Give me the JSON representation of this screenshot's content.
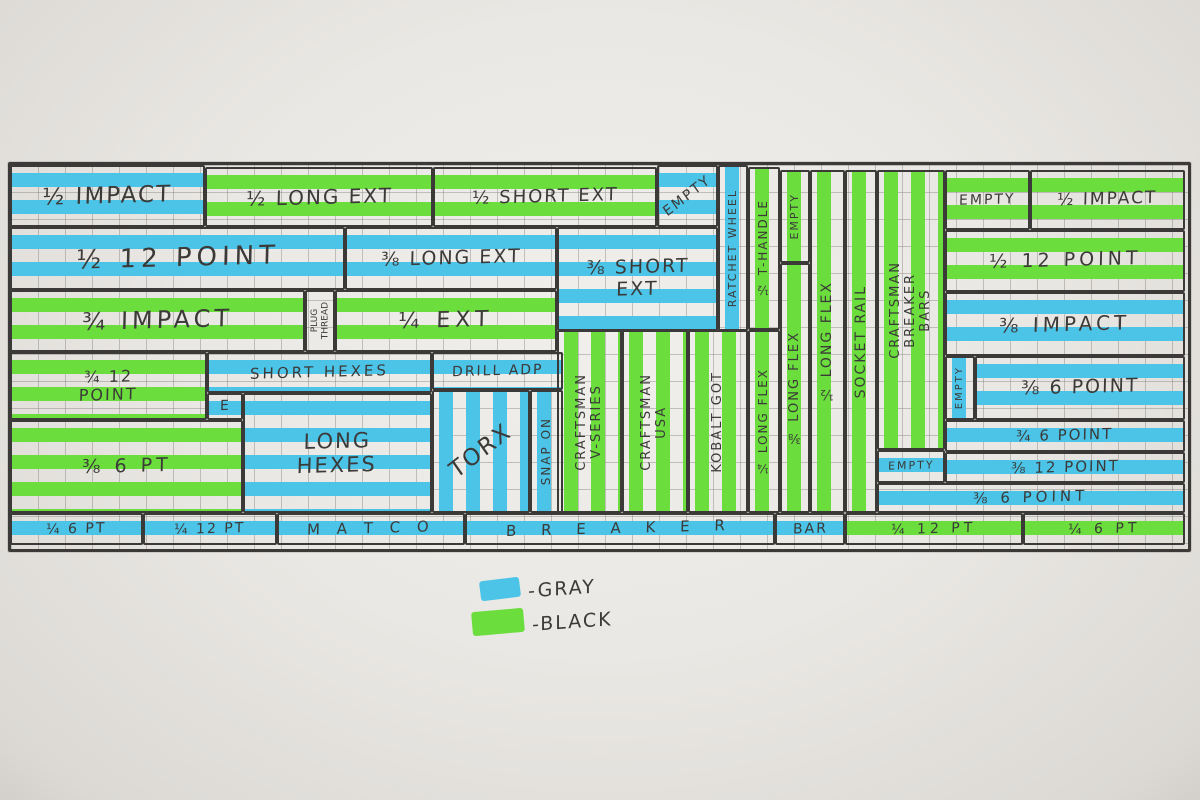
{
  "colors": {
    "blue": "#4cc4e8",
    "green": "#6bdd3d",
    "ink": "#3b3a38",
    "paper": "#eae8e4",
    "grid_line": "#696661"
  },
  "legend": {
    "items": [
      {
        "name": "gray",
        "label": "-GRAY",
        "color": "#4cc4e8"
      },
      {
        "name": "black",
        "label": "-BLACK",
        "color": "#6bdd3d"
      }
    ]
  },
  "cells": [
    {
      "name": "cell-half-impact-left",
      "label": "½ IMPACT",
      "marker": "blue",
      "stripes": "h",
      "orient": "h",
      "box": [
        10,
        165,
        195,
        62
      ],
      "fs": 23
    },
    {
      "name": "cell-half-long-ext",
      "label": "½ LONG EXT",
      "marker": "green",
      "stripes": "h",
      "orient": "h",
      "box": [
        205,
        167,
        228,
        60
      ],
      "fs": 20
    },
    {
      "name": "cell-half-short-ext",
      "label": "½ SHORT EXT",
      "marker": "green",
      "stripes": "h",
      "orient": "h",
      "box": [
        433,
        167,
        224,
        60
      ],
      "fs": 18
    },
    {
      "name": "cell-empty-top-blue",
      "label": "EMPTY",
      "marker": "blue",
      "stripes": "h",
      "orient": "diag",
      "box": [
        657,
        165,
        61,
        62
      ],
      "fs": 14
    },
    {
      "name": "cell-ratchet-wheel",
      "label": "RATCHET WHEEL",
      "marker": "blue",
      "stripes": "v",
      "orient": "v",
      "box": [
        718,
        165,
        30,
        166
      ],
      "fs": 11
    },
    {
      "name": "cell-half-12-point-left",
      "label": "½  12  POINT",
      "marker": "blue",
      "stripes": "h",
      "orient": "h",
      "box": [
        10,
        227,
        335,
        63
      ],
      "fs": 26,
      "ls": 5
    },
    {
      "name": "cell-three-eighths-long-ext",
      "label": "⅜ LONG EXT",
      "marker": "blue",
      "stripes": "h",
      "orient": "h",
      "box": [
        345,
        227,
        212,
        63
      ],
      "fs": 19
    },
    {
      "name": "cell-three-eighths-short-ext",
      "label": "⅜ SHORT\nEXT",
      "marker": "blue",
      "stripes": "h",
      "orient": "h",
      "box": [
        557,
        227,
        161,
        104
      ],
      "fs": 19
    },
    {
      "name": "cell-three-quarters-impact",
      "label": "¾  IMPACT",
      "marker": "green",
      "stripes": "h",
      "orient": "h",
      "box": [
        10,
        290,
        295,
        62
      ],
      "fs": 24,
      "ls": 4
    },
    {
      "name": "cell-plug-thread",
      "label": "PLUG\nTHREAD",
      "marker": "none",
      "stripes": "n",
      "orient": "v",
      "box": [
        305,
        290,
        30,
        62
      ],
      "fs": 9,
      "ls": 0
    },
    {
      "name": "cell-quarter-ext",
      "label": "¼  EXT",
      "marker": "green",
      "stripes": "h",
      "orient": "h",
      "box": [
        335,
        290,
        222,
        62
      ],
      "fs": 22,
      "ls": 5
    },
    {
      "name": "cell-three-quarters-12-point",
      "label": "¾   12\nPOINT",
      "marker": "green",
      "stripes": "h",
      "orient": "h",
      "box": [
        10,
        352,
        197,
        68
      ],
      "fs": 16
    },
    {
      "name": "cell-short-hexes",
      "label": "SHORT HEXES",
      "marker": "blue",
      "stripes": "h",
      "orient": "h",
      "box": [
        207,
        352,
        225,
        41
      ],
      "fs": 15,
      "ls": 3
    },
    {
      "name": "cell-drill-adp",
      "label": "DRILL ADP",
      "marker": "blue",
      "stripes": "h",
      "orient": "h",
      "box": [
        432,
        352,
        131,
        38
      ],
      "fs": 14
    },
    {
      "name": "cell-e",
      "label": "E",
      "marker": "blue",
      "stripes": "h",
      "orient": "h",
      "box": [
        207,
        393,
        36,
        27
      ],
      "fs": 14
    },
    {
      "name": "cell-long-hexes",
      "label": "LONG\nHEXES",
      "marker": "blue",
      "stripes": "h",
      "orient": "h",
      "box": [
        243,
        393,
        189,
        120
      ],
      "fs": 21
    },
    {
      "name": "cell-three-eighths-6-pt",
      "label": "⅜   6 PT",
      "marker": "green",
      "stripes": "h",
      "orient": "h",
      "box": [
        10,
        420,
        233,
        93
      ],
      "fs": 19,
      "ls": 4
    },
    {
      "name": "cell-torx",
      "label": "TORX",
      "marker": "blue",
      "stripes": "v",
      "orient": "diag",
      "box": [
        432,
        390,
        98,
        123
      ],
      "fs": 23
    },
    {
      "name": "cell-snap-on",
      "label": "SNAP ON",
      "marker": "blue",
      "stripes": "v",
      "orient": "v",
      "box": [
        530,
        390,
        33,
        123
      ],
      "fs": 12
    },
    {
      "name": "cell-craftsman-v-series",
      "label": "CRAFTSMAN\nV-SERIES",
      "marker": "green",
      "stripes": "v",
      "orient": "v",
      "box": [
        557,
        330,
        65,
        183
      ],
      "fs": 13
    },
    {
      "name": "cell-craftsman-usa",
      "label": "CRAFTSMAN\nUSA",
      "marker": "green",
      "stripes": "v",
      "orient": "v",
      "box": [
        622,
        330,
        66,
        183
      ],
      "fs": 13
    },
    {
      "name": "cell-kobalt",
      "label": "KOBALT GOT",
      "marker": "green",
      "stripes": "v",
      "orient": "v",
      "box": [
        688,
        330,
        60,
        183
      ],
      "fs": 13
    },
    {
      "name": "cell-half-t-handle",
      "label": "½ T-HANDLE",
      "marker": "green",
      "stripes": "v",
      "orient": "v",
      "box": [
        748,
        167,
        32,
        163
      ],
      "fs": 12
    },
    {
      "name": "cell-quarter-long-flex",
      "label": "¼ LONG FLEX",
      "marker": "green",
      "stripes": "v",
      "orient": "v",
      "box": [
        748,
        330,
        32,
        183
      ],
      "fs": 12
    },
    {
      "name": "cell-empty-green-col",
      "label": "EMPTY",
      "marker": "green",
      "stripes": "v",
      "orient": "v",
      "box": [
        780,
        170,
        30,
        93
      ],
      "fs": 11
    },
    {
      "name": "cell-three-eighths-long-flex",
      "label": "⅜ LONG FLEX",
      "marker": "green",
      "stripes": "v",
      "orient": "v",
      "box": [
        780,
        263,
        30,
        250
      ],
      "fs": 13
    },
    {
      "name": "cell-half-long-flex",
      "label": "½ LONG FLEX",
      "marker": "green",
      "stripes": "v",
      "orient": "v",
      "box": [
        810,
        170,
        35,
        343
      ],
      "fs": 14
    },
    {
      "name": "cell-socket-rail",
      "label": "SOCKET RAIL",
      "marker": "green",
      "stripes": "v",
      "orient": "v",
      "box": [
        845,
        170,
        32,
        343
      ],
      "fs": 14
    },
    {
      "name": "cell-craftsman-breaker-bars",
      "label": "CRAFTSMAN\nBREAKER\nBARS",
      "marker": "green",
      "stripes": "v",
      "orient": "v",
      "box": [
        877,
        170,
        68,
        280
      ],
      "fs": 13
    },
    {
      "name": "cell-empty-under-breaker",
      "label": "EMPTY",
      "marker": "blue",
      "stripes": "h",
      "orient": "h",
      "box": [
        877,
        450,
        68,
        33
      ],
      "fs": 11
    },
    {
      "name": "cell-empty-top-right",
      "label": "EMPTY",
      "marker": "green",
      "stripes": "h",
      "orient": "h",
      "box": [
        945,
        170,
        85,
        60
      ],
      "fs": 14
    },
    {
      "name": "cell-half-impact-right",
      "label": "½ IMPACT",
      "marker": "green",
      "stripes": "h",
      "orient": "h",
      "box": [
        1030,
        170,
        155,
        60
      ],
      "fs": 17
    },
    {
      "name": "cell-half-12-point-right",
      "label": "½  12  POINT",
      "marker": "green",
      "stripes": "h",
      "orient": "h",
      "box": [
        945,
        230,
        240,
        62
      ],
      "fs": 19,
      "ls": 4
    },
    {
      "name": "cell-three-eighths-impact",
      "label": "⅜  IMPACT",
      "marker": "blue",
      "stripes": "h",
      "orient": "h",
      "box": [
        945,
        292,
        240,
        64
      ],
      "fs": 20,
      "ls": 4
    },
    {
      "name": "cell-empty-vert-right",
      "label": "EMPTY",
      "marker": "blue",
      "stripes": "v",
      "orient": "v",
      "box": [
        945,
        356,
        30,
        64
      ],
      "fs": 10
    },
    {
      "name": "cell-three-eighths-6-point",
      "label": "⅜  6 POINT",
      "marker": "blue",
      "stripes": "h",
      "orient": "h",
      "box": [
        975,
        356,
        210,
        64
      ],
      "fs": 19
    },
    {
      "name": "cell-three-quarters-6-point",
      "label": "¾  6 POINT",
      "marker": "blue",
      "stripes": "h",
      "orient": "h",
      "box": [
        945,
        420,
        240,
        32
      ],
      "fs": 15
    },
    {
      "name": "cell-three-eighths-12-point",
      "label": "⅜  12 POINT",
      "marker": "blue",
      "stripes": "h",
      "orient": "h",
      "box": [
        945,
        452,
        240,
        31
      ],
      "fs": 15
    },
    {
      "name": "cell-three-eighths-6-point-wide",
      "label": "⅜   6   POINT",
      "marker": "blue",
      "stripes": "h",
      "orient": "h",
      "box": [
        877,
        483,
        308,
        30
      ],
      "fs": 15,
      "ls": 4
    },
    {
      "name": "cell-quarter-6-pt-bottom-left",
      "label": "¼ 6 PT",
      "marker": "blue",
      "stripes": "h",
      "orient": "h",
      "box": [
        10,
        513,
        133,
        32
      ],
      "fs": 14
    },
    {
      "name": "cell-quarter-12-pt-bottom-left",
      "label": "¼ 12 PT",
      "marker": "blue",
      "stripes": "h",
      "orient": "h",
      "box": [
        143,
        513,
        134,
        32
      ],
      "fs": 14
    },
    {
      "name": "cell-matco",
      "label": "M A T C O",
      "marker": "blue",
      "stripes": "h",
      "orient": "h",
      "box": [
        277,
        513,
        188,
        32
      ],
      "fs": 15,
      "ls": 6
    },
    {
      "name": "cell-breaker",
      "label": "B R E A K E R",
      "marker": "blue",
      "stripes": "h",
      "orient": "h",
      "box": [
        465,
        513,
        310,
        32
      ],
      "fs": 15,
      "ls": 10
    },
    {
      "name": "cell-bar",
      "label": "BAR",
      "marker": "blue",
      "stripes": "h",
      "orient": "h",
      "box": [
        775,
        513,
        70,
        32
      ],
      "fs": 14
    },
    {
      "name": "cell-quarter-12-pt-bottom-right",
      "label": "¼  12 PT",
      "marker": "green",
      "stripes": "h",
      "orient": "h",
      "box": [
        845,
        513,
        178,
        32
      ],
      "fs": 14,
      "ls": 4
    },
    {
      "name": "cell-quarter-6-pt-bottom-right",
      "label": "¼  6 PT",
      "marker": "green",
      "stripes": "h",
      "orient": "h",
      "box": [
        1023,
        513,
        162,
        32
      ],
      "fs": 14,
      "ls": 4
    }
  ]
}
